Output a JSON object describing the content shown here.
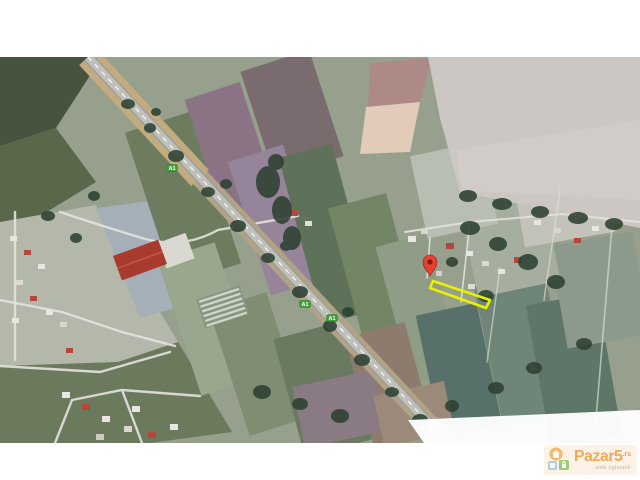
{
  "page": {
    "background_color": "#ffffff",
    "photo_area": {
      "top": 57,
      "bottom": 443
    }
  },
  "map": {
    "kind": "satellite-photo",
    "pin": {
      "x": 430,
      "y": 262,
      "color": "#e54130",
      "stroke_color": "#8e2015",
      "dot_color": "#7d1c10"
    },
    "parcel": {
      "points": "433,281 490,300 486,308 430,288",
      "stroke_color": "#e9f000",
      "stroke_width": 2.6
    },
    "route_shields": {
      "fill": "#3f9f3a",
      "border": "#2d7a29",
      "text_color": "#ffffff",
      "items": [
        {
          "label": "A1",
          "x": 172,
          "y": 168
        },
        {
          "label": "A1",
          "x": 305,
          "y": 304
        },
        {
          "label": "A1",
          "x": 332,
          "y": 318
        }
      ]
    }
  },
  "watermark": {
    "brand": "Pazar5",
    "tld": ".rs",
    "tagline": "web oglasnik",
    "brand_color": "#ef8f2d",
    "background_color": "#fce9d4",
    "icon": {
      "house_circle_color": "#f4a23d",
      "lock_square_color": "#84bf4a",
      "box_color": "#9fc0da"
    }
  }
}
